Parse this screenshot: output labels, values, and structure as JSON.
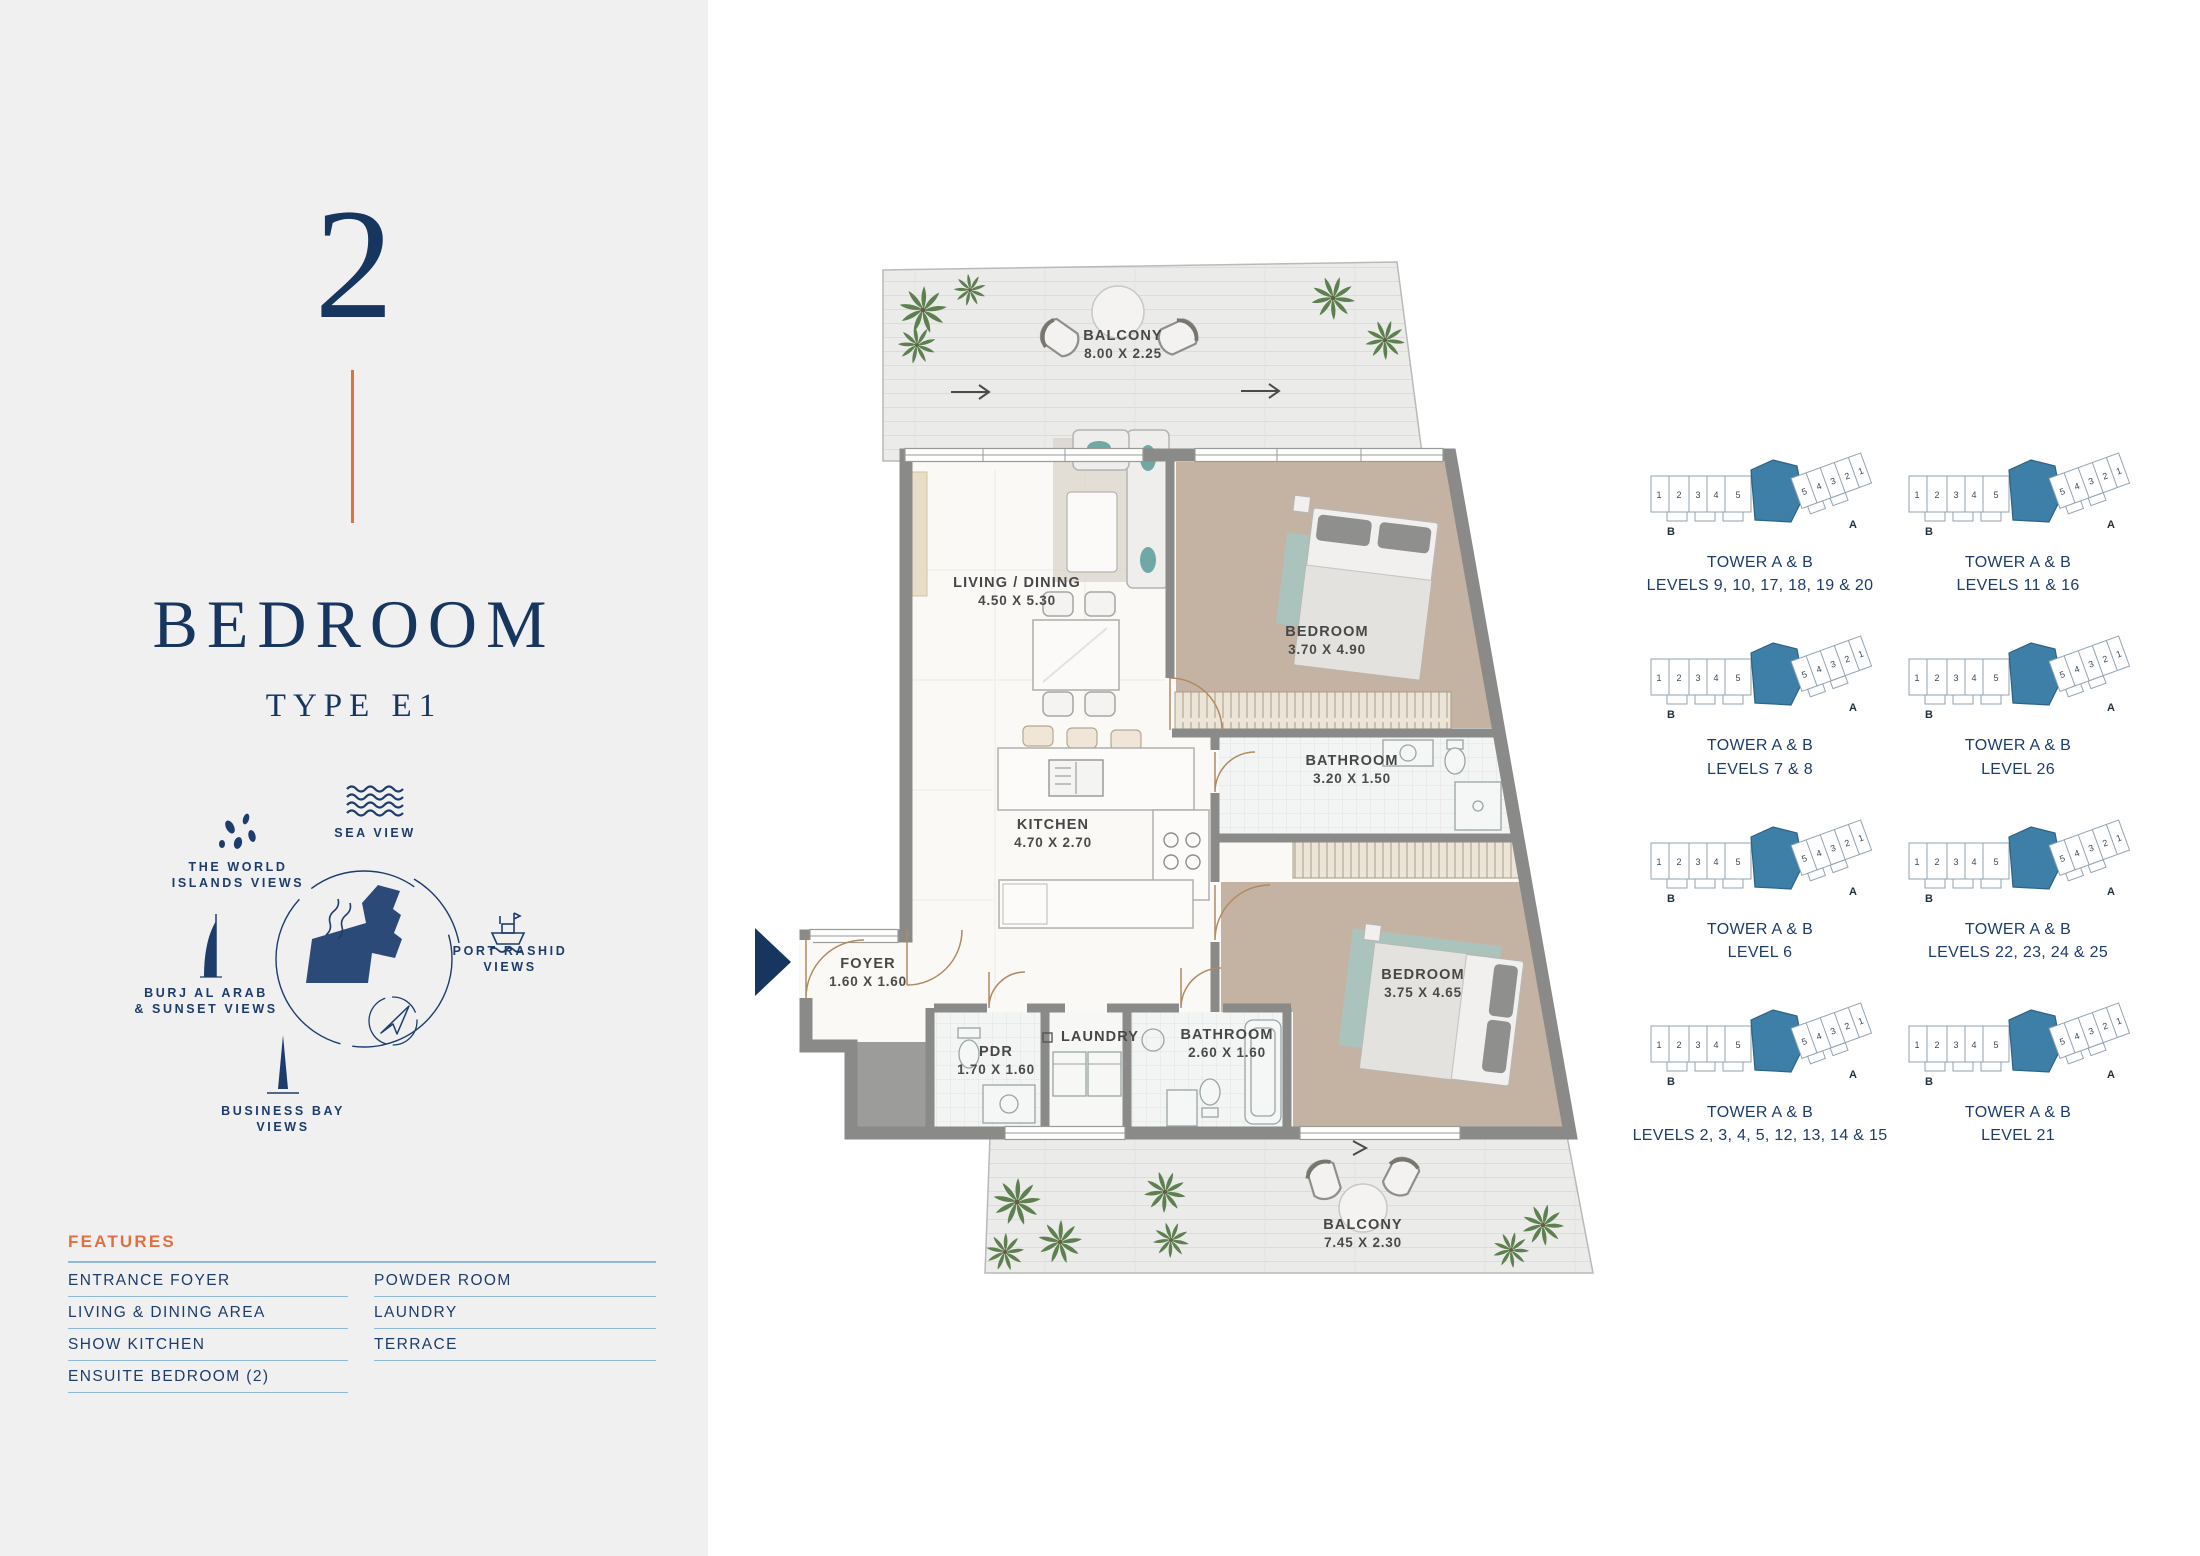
{
  "colors": {
    "navy": "#16355f",
    "orange": "#e0703f",
    "underline_blue": "#8fb9d9",
    "teal_highlight": "#3d7fa6",
    "wall_gray": "#8a8a88",
    "sidebar_bg": "#f0f0f1"
  },
  "sidebar": {
    "unit_number": "2",
    "title": "BEDROOM",
    "subtitle": "TYPE E1",
    "views": {
      "sea": "SEA VIEW",
      "world1": "THE WORLD",
      "world2": "ISLANDS VIEWS",
      "port1": "PORT RASHID",
      "port2": "VIEWS",
      "burj1": "BURJ AL ARAB",
      "burj2": "& SUNSET VIEWS",
      "bay1": "BUSINESS BAY",
      "bay2": "VIEWS"
    },
    "features": {
      "heading": "FEATURES",
      "col1": [
        "ENTRANCE FOYER",
        "LIVING & DINING AREA",
        "SHOW KITCHEN",
        "ENSUITE BEDROOM (2)"
      ],
      "col2": [
        "POWDER ROOM",
        "LAUNDRY",
        "TERRACE"
      ]
    }
  },
  "plan": {
    "rooms": [
      {
        "name": "BALCONY",
        "dims": "8.00 X 2.25",
        "x": 368,
        "y": 100
      },
      {
        "name": "LIVING / DINING",
        "dims": "4.50 X 5.30",
        "x": 262,
        "y": 347
      },
      {
        "name": "BEDROOM",
        "dims": "3.70 X 4.90",
        "x": 572,
        "y": 396
      },
      {
        "name": "KITCHEN",
        "dims": "4.70 X 2.70",
        "x": 298,
        "y": 589
      },
      {
        "name": "BATHROOM",
        "dims": "3.20 X 1.50",
        "x": 597,
        "y": 525
      },
      {
        "name": "FOYER",
        "dims": "1.60 X 1.60",
        "x": 113,
        "y": 728
      },
      {
        "name": "PDR",
        "dims": "1.70 X 1.60",
        "x": 241,
        "y": 816
      },
      {
        "name": "LAUNDRY",
        "dims": "",
        "x": 345,
        "y": 801
      },
      {
        "name": "BATHROOM",
        "dims": "2.60 X 1.60",
        "x": 472,
        "y": 799
      },
      {
        "name": "BEDROOM",
        "dims": "3.75 X 4.65",
        "x": 668,
        "y": 739
      },
      {
        "name": "BALCONY",
        "dims": "7.45 X 2.30",
        "x": 608,
        "y": 989
      }
    ]
  },
  "key_plans": {
    "unit_numbers": [
      "1",
      "2",
      "3",
      "4",
      "5"
    ],
    "wing_a": "A",
    "wing_b": "B",
    "items": [
      {
        "line1": "TOWER A & B",
        "line2": "LEVELS 9, 10, 17, 18, 19 & 20"
      },
      {
        "line1": "TOWER A & B",
        "line2": "LEVELS 11 & 16"
      },
      {
        "line1": "TOWER A & B",
        "line2": "LEVELS 7 & 8"
      },
      {
        "line1": "TOWER A & B",
        "line2": "LEVEL 26"
      },
      {
        "line1": "TOWER A & B",
        "line2": "LEVEL 6"
      },
      {
        "line1": "TOWER A & B",
        "line2": "LEVELS 22, 23, 24 & 25"
      },
      {
        "line1": "TOWER A & B",
        "line2": "LEVELS 2, 3, 4, 5, 12, 13, 14 & 15"
      },
      {
        "line1": "TOWER A & B",
        "line2": "LEVEL 21"
      }
    ]
  }
}
